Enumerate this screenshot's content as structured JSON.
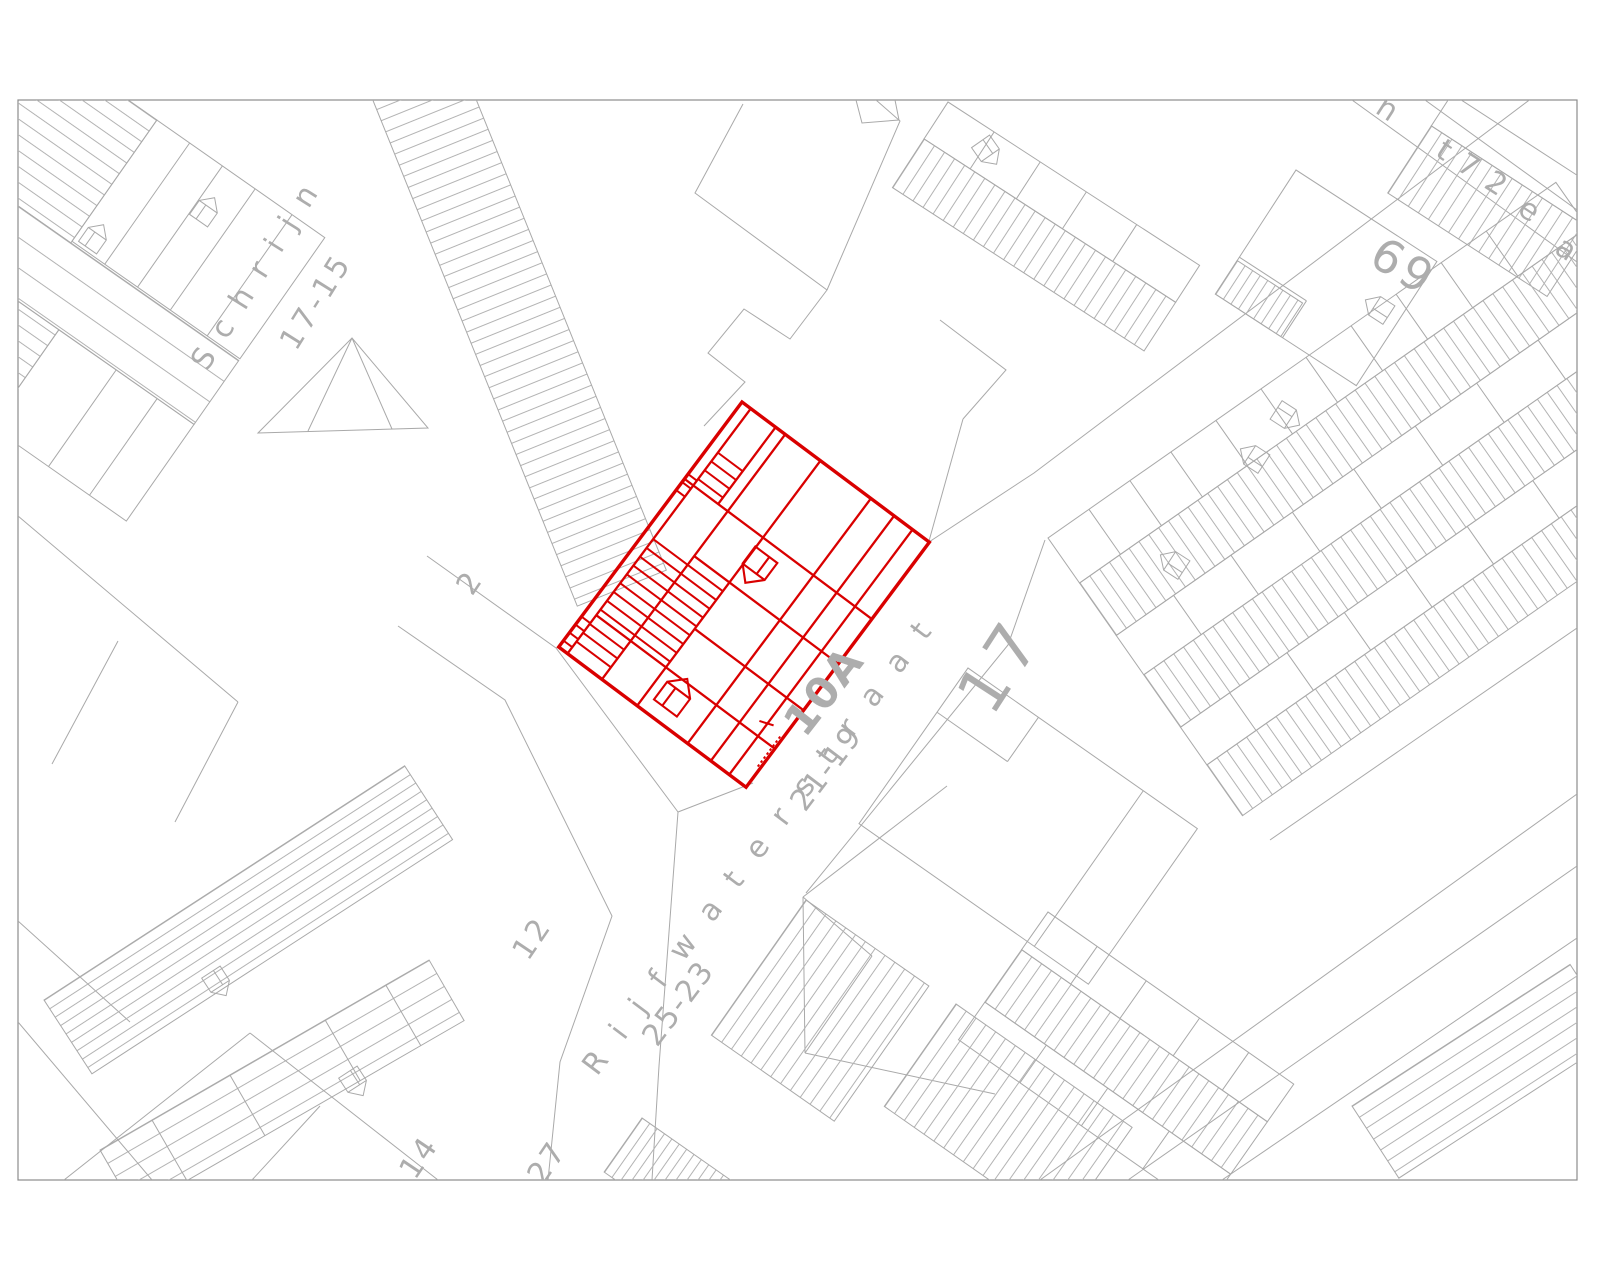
{
  "map": {
    "type": "cadastral-parcel-map",
    "colors": {
      "background": "#ffffff",
      "line_gray": "#a9a9a9",
      "text_gray": "#adadad",
      "frame_gray": "#8c8c8c",
      "highlight_red": "#d90000"
    },
    "highlight": {
      "parcel_label": "10A"
    },
    "street_names": [
      "Schrijn",
      "Rijfwaterstraat"
    ],
    "house_numbers": [
      "17-15",
      "2",
      "12",
      "14",
      "27",
      "25-23",
      "21-19",
      "17",
      "69",
      "72"
    ],
    "labels": [
      {
        "id": "street-schrijn",
        "text": "Schrijn",
        "x": 207,
        "y": 372,
        "rot": -58,
        "size": 30,
        "ls": 18
      },
      {
        "id": "num-17-15",
        "text": "17-15",
        "x": 296,
        "y": 352,
        "rot": -58,
        "size": 30,
        "ls": 4
      },
      {
        "id": "num-2",
        "text": "2",
        "x": 472,
        "y": 597,
        "rot": -56,
        "size": 30,
        "ls": 0
      },
      {
        "id": "num-12",
        "text": "12",
        "x": 528,
        "y": 962,
        "rot": -56,
        "size": 30,
        "ls": 3
      },
      {
        "id": "num-14",
        "text": "14",
        "x": 415,
        "y": 1181,
        "rot": -56,
        "size": 30,
        "ls": 3
      },
      {
        "id": "num-27",
        "text": "27",
        "x": 543,
        "y": 1186,
        "rot": -56,
        "size": 30,
        "ls": 3
      },
      {
        "id": "street-rijfwaterstraat",
        "text": "Rijfwaterstraat",
        "x": 597,
        "y": 1077,
        "rot": -53,
        "size": 30,
        "ls": 24
      },
      {
        "id": "num-25-23",
        "text": "25-23",
        "x": 657,
        "y": 1048,
        "rot": -53,
        "size": 30,
        "ls": 2
      },
      {
        "id": "num-21-19",
        "text": "21-19",
        "x": 805,
        "y": 813,
        "rot": -53,
        "size": 30,
        "ls": 2
      },
      {
        "id": "parcel-10A",
        "text": "10A",
        "x": 805,
        "y": 739,
        "rot": -52,
        "size": 43,
        "ls": 2,
        "color": "#d90000",
        "bold": true
      },
      {
        "id": "num-17",
        "text": "17",
        "x": 992,
        "y": 718,
        "rot": -57,
        "size": 64,
        "ls": 8
      },
      {
        "id": "num-69",
        "text": "69",
        "x": 1367,
        "y": 263,
        "rot": 31,
        "size": 46,
        "ls": 4
      },
      {
        "id": "street3-n",
        "text": "n",
        "x": 1374,
        "y": 112,
        "rot": 33,
        "size": 30,
        "ls": 0
      },
      {
        "id": "street3-t72",
        "text": "t 7 2",
        "x": 1434,
        "y": 155,
        "rot": 33,
        "size": 30,
        "ls": 2
      },
      {
        "id": "street3-e",
        "text": "e",
        "x": 1516,
        "y": 213,
        "rot": 33,
        "size": 30,
        "ls": 0
      },
      {
        "id": "street3-a",
        "text": "a",
        "x": 1553,
        "y": 252,
        "rot": 33,
        "size": 30,
        "ls": 0
      }
    ]
  }
}
